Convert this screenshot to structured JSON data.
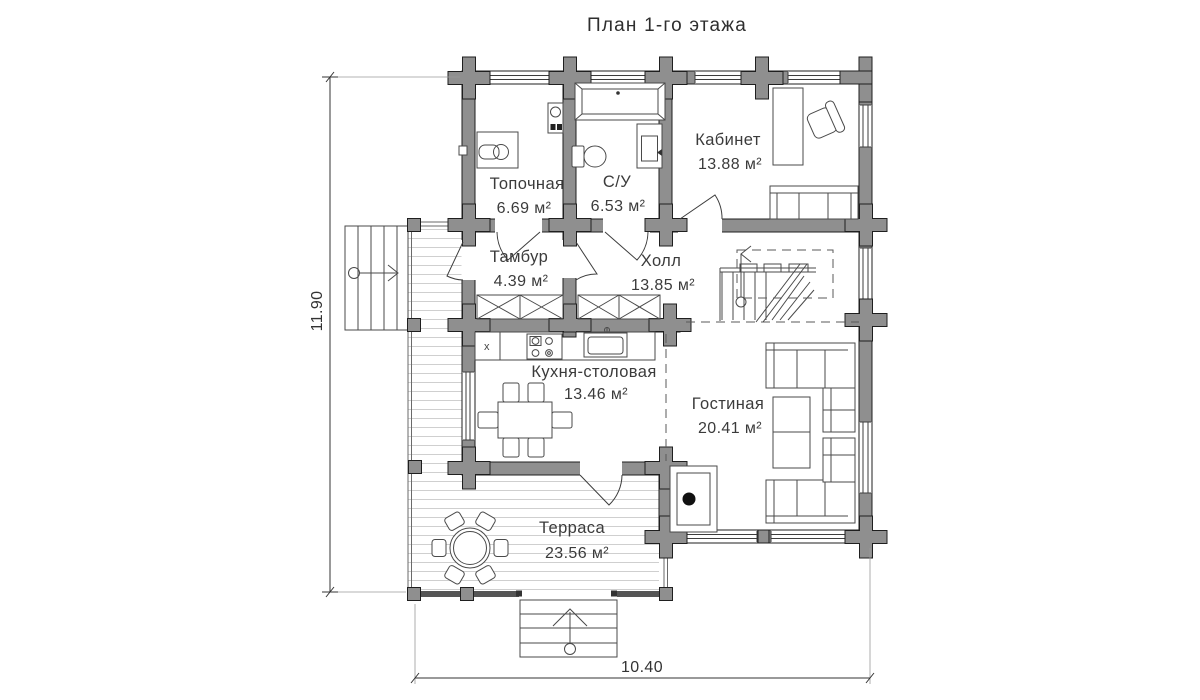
{
  "title": "План 1-го этажа",
  "dimensions": {
    "height_m": "11.90",
    "width_m": "10.40"
  },
  "rooms": [
    {
      "name": "Топочная",
      "area": "6.69 м²"
    },
    {
      "name": "С/У",
      "area": "6.53 м²"
    },
    {
      "name": "Кабинет",
      "area": "13.88 м²"
    },
    {
      "name": "Тамбур",
      "area": "4.39 м²"
    },
    {
      "name": "Холл",
      "area": "13.85 м²"
    },
    {
      "name": "Кухня-столовая",
      "area": "13.46 м²"
    },
    {
      "name": "Гостиная",
      "area": "20.41 м²"
    },
    {
      "name": "Терраса",
      "area": "23.56 м²"
    }
  ],
  "annotations": {
    "kitchen_marker": "x"
  },
  "colors": {
    "wall": "#8f8f8f",
    "text": "#3b3b3b",
    "deck_line": "#cfcfcf"
  }
}
